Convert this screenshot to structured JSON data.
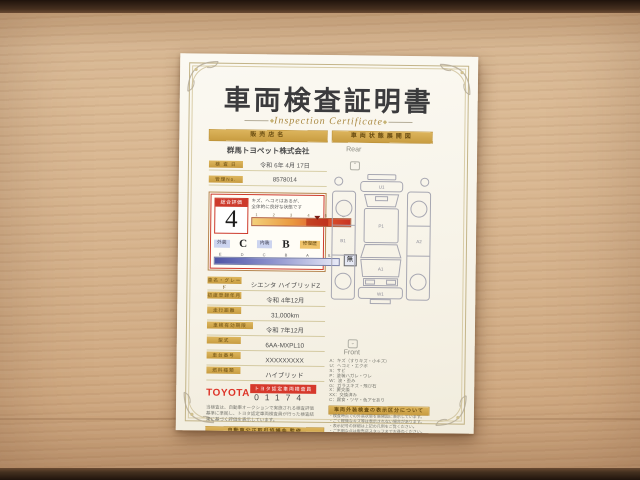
{
  "document": {
    "title": "車両検査証明書",
    "subtitle": "Inspection Certificate",
    "left": {
      "shop_header": "販売店名",
      "shop_name": "群馬トヨペット株式会社",
      "date_label": "検 査 日",
      "date_value": "令和 6年 4月 17日",
      "no_label": "管理No.",
      "no_value": "8578014",
      "evaluation": {
        "label": "総合評価",
        "score": "4",
        "note_line1": "キズ、ヘコミはあるが、",
        "note_line2": "全体的に良好な状態です",
        "scale_ticks": "1 2 3 4 5 S",
        "exterior_label": "外装",
        "exterior_value": "C",
        "interior_label": "内装",
        "interior_value": "B",
        "repair_label": "修復歴",
        "repair_value": "無",
        "grade_ticks": "E D C B A S"
      },
      "fields": [
        {
          "label": "車名・グレード",
          "value": "シエンタ ハイブリッドZ"
        },
        {
          "label": "初度登録年月",
          "value": "令和 4年12月"
        },
        {
          "label": "走行距離",
          "value": "31,000km"
        },
        {
          "label": "車検有効期限",
          "value": "令和 7年12月"
        },
        {
          "label": "型式",
          "value": "6AA-MXPL10"
        },
        {
          "label": "車台番号",
          "value": "XXXXXXXXX"
        },
        {
          "label": "燃料種類",
          "value": "ハイブリッド"
        }
      ],
      "inspector": {
        "brand": "TOYOTA",
        "badge": "トヨタ認定車両検査員",
        "number": "01174"
      },
      "disclaimer_lines": [
        "当検査は、自動車オークションで実施される検査評価",
        "基準に準拠し、トヨタ認定車両検査員が行った検査結",
        "果に基づく評価を表示しています。"
      ],
      "footer": {
        "bar": "自動車公正取引協議会 監修",
        "line1": "・本証明書は中古自動車の品質表示に関する",
        "line2": "　公正競争規約に基づき表示しています。"
      }
    },
    "right": {
      "header": "車両状態展開図",
      "rear_label": "Rear",
      "front_label": "Front",
      "codes": {
        "rear_bumper": "U1",
        "roof": "P1",
        "door_left": "B1",
        "door_right": "A2",
        "hood": "A1",
        "front_bumper": "W1"
      },
      "legend_lines": [
        "A：キズ（すりキズ・小キズ）",
        "U：ヘコミ・エクボ",
        "S：サビ",
        "P：塗装ハガレ・ワレ",
        "W：波・歪み",
        "G：ガラスキズ・飛び石",
        "X：要交換",
        "XX：交換済み",
        "C：腐食・ツヤ・色アセあり"
      ],
      "notice_bar": "車両外装検査の表示区分について",
      "notice_lines": [
        "・検査時点での外装状態を展開図に表示しています。",
        "・ごく軽微なキズ等は表示されない場合があります。",
        "・表示記号の詳細は上記の凡例をご覧ください。",
        "・ご不明な点は販売店スタッフまでお尋ねください。"
      ],
      "footer": {
        "bar": "日本自動車査定協会 定期監査",
        "logo": "JAAI",
        "line1": "本検査は検査時点での",
        "line2": "車両状態を表示したもの",
        "line3": "です。"
      }
    }
  }
}
